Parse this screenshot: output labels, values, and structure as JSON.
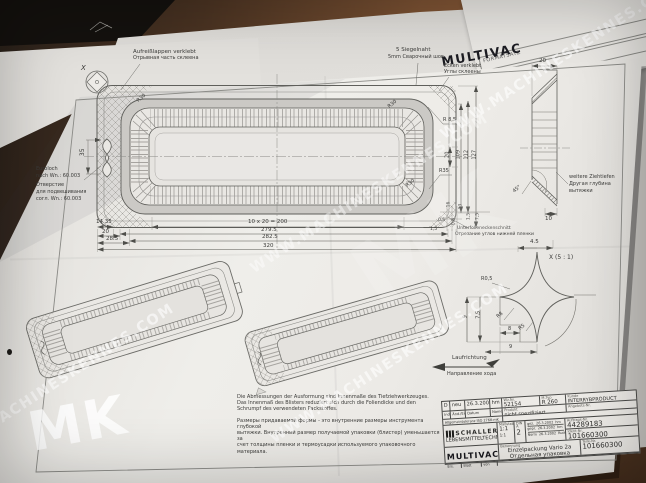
{
  "colors": {
    "desk": "#7c5233",
    "sheet": "#edebe7",
    "line": "#5d5d5a",
    "watermark": "#ffffff"
  },
  "watermark": {
    "url": "WWW.MACHINESKENNES.COM",
    "logo": "MK"
  },
  "background": {
    "back_sheet_title": "FORMATSATZ",
    "back_sheet_title2": "FORMATSATZ",
    "brand": "MULTIVAC"
  },
  "annotations": {
    "aufreiss_de": "Aufreißlappen verklebt",
    "aufreiss_ru": "Отрывная часть склеена",
    "siegel_de": "5 Siegelnaht",
    "siegel_ru": "5mm Сварочный шов",
    "ecken_de": "Ecken verklebt",
    "ecken_ru": "Углы склеены",
    "euroloch_de1": "Euroloch",
    "euroloch_de2": "nach Wn.: 60.003",
    "euroloch_ru1": "Отверстие",
    "euroloch_ru2": "для подвешивания",
    "euroloch_ru3": "согл. Wn.: 60.003",
    "unterfolie_de": "Unterfolieneckenschnitt",
    "unterfolie_ru": "Отрезание углов нижней пленки",
    "ziehtiefen_de": "weitere Ziehtiefen",
    "ziehtiefen_ru1": "Другая глубина",
    "ziehtiefen_ru2": "вытяжки",
    "lauf_de": "Laufrichtung",
    "lauf_ru": "Направление хода",
    "x_callout": "X",
    "detail_title": "X (5 : 1)"
  },
  "dims": {
    "d35": "35",
    "d14_35": "14.35",
    "d20": "20",
    "d28_5": "28.5",
    "d10x20": "10 x 20 = 200",
    "d279_5": "279.5",
    "d282_5": "282.5",
    "d320": "320",
    "r30": "R30",
    "r8_5": "R 8,5",
    "r35": "R35",
    "v20": "20",
    "v109": "109",
    "v112": "112",
    "v127": "127",
    "s16": "16",
    "s13": "13",
    "s0_5": "0,5",
    "s0_6": "0,6",
    "s1_5": "1,5",
    "s7_5": "7,5",
    "sv20": "20",
    "a45": "45°",
    "sv10": "10",
    "x4_5": "4.5",
    "xr0_5": "R0,5",
    "x9": "9",
    "x7_5": "7,5",
    "xr8": "R8",
    "xr5": "R5",
    "x8": "8",
    "x9b": "9"
  },
  "notes": {
    "de1": "Die Abmessungen der Ausformung sind Innenmaße des Tiefziehwerkzeuges.",
    "de2": "Das Innenmaß des Blisters reduziert sich durch die Foliendicke und den",
    "de3": "Schrumpf des verwendeten Packstoffes.",
    "ru1": "Размеры придаваемой формы - это внутренние размеры инструмента глубокой",
    "ru2": "вытяжки. Внутренний размер получаемой упаковки (блистер) уменьшается за",
    "ru3": "счет толщины пленки и термоусадки используемого упаковочного материала."
  },
  "titleblock": {
    "rev": {
      "index": "D",
      "change": "neu",
      "date": "26.3.2002",
      "name": "hm"
    },
    "rev_labels": {
      "index": "Index",
      "change": "Änd./Ers.",
      "date": "Datum",
      "name": "Name"
    },
    "tolerance": "Allgemeintoleranz ISO 2768-mK",
    "wz": {
      "label": "Wz.Nr.",
      "value": "52154"
    },
    "mtyp": {
      "label": "M.Typ",
      "value": "R 260"
    },
    "kunde": {
      "label": "Kunde",
      "value": "INTERRYBPRODUCT"
    },
    "produkt": {
      "label": "Produkt",
      "value": "nicht spezifiziert"
    },
    "angebot": {
      "label": "Angebots-Nr.",
      "value": ""
    },
    "massstab": {
      "label": "Maßstab",
      "value": "1:1",
      "value2": "1:1"
    },
    "format": {
      "label": "DIN A",
      "value": "2"
    },
    "sign_rows": [
      {
        "label": "gez.",
        "date": "26.3.2002",
        "name": "hm"
      },
      {
        "label": "gepr.",
        "date": "26.3.2002",
        "name": "hm"
      },
      {
        "label": "Norm",
        "date": "26.3.2002",
        "name": "Rudolph"
      }
    ],
    "auftrag": {
      "label": "Auftrags-Nr.",
      "value": "44289183"
    },
    "ident": {
      "label": "Ident-Nr.",
      "value": "101660300"
    },
    "benennung": {
      "label": "Benennung",
      "line1": "Einzelpackung Vario 2a",
      "line2": "Отдельная упаковка"
    },
    "teile": {
      "label": "Teile-Nr.",
      "value": "101660300"
    },
    "schaller": {
      "name": "SCHALLER",
      "sub": "LEBENSMITTELTECHNIK"
    },
    "multivac": "MULTIVAC",
    "footer": {
      "ers": "Ers.",
      "blatt": "Blatt",
      "von": "von"
    }
  }
}
